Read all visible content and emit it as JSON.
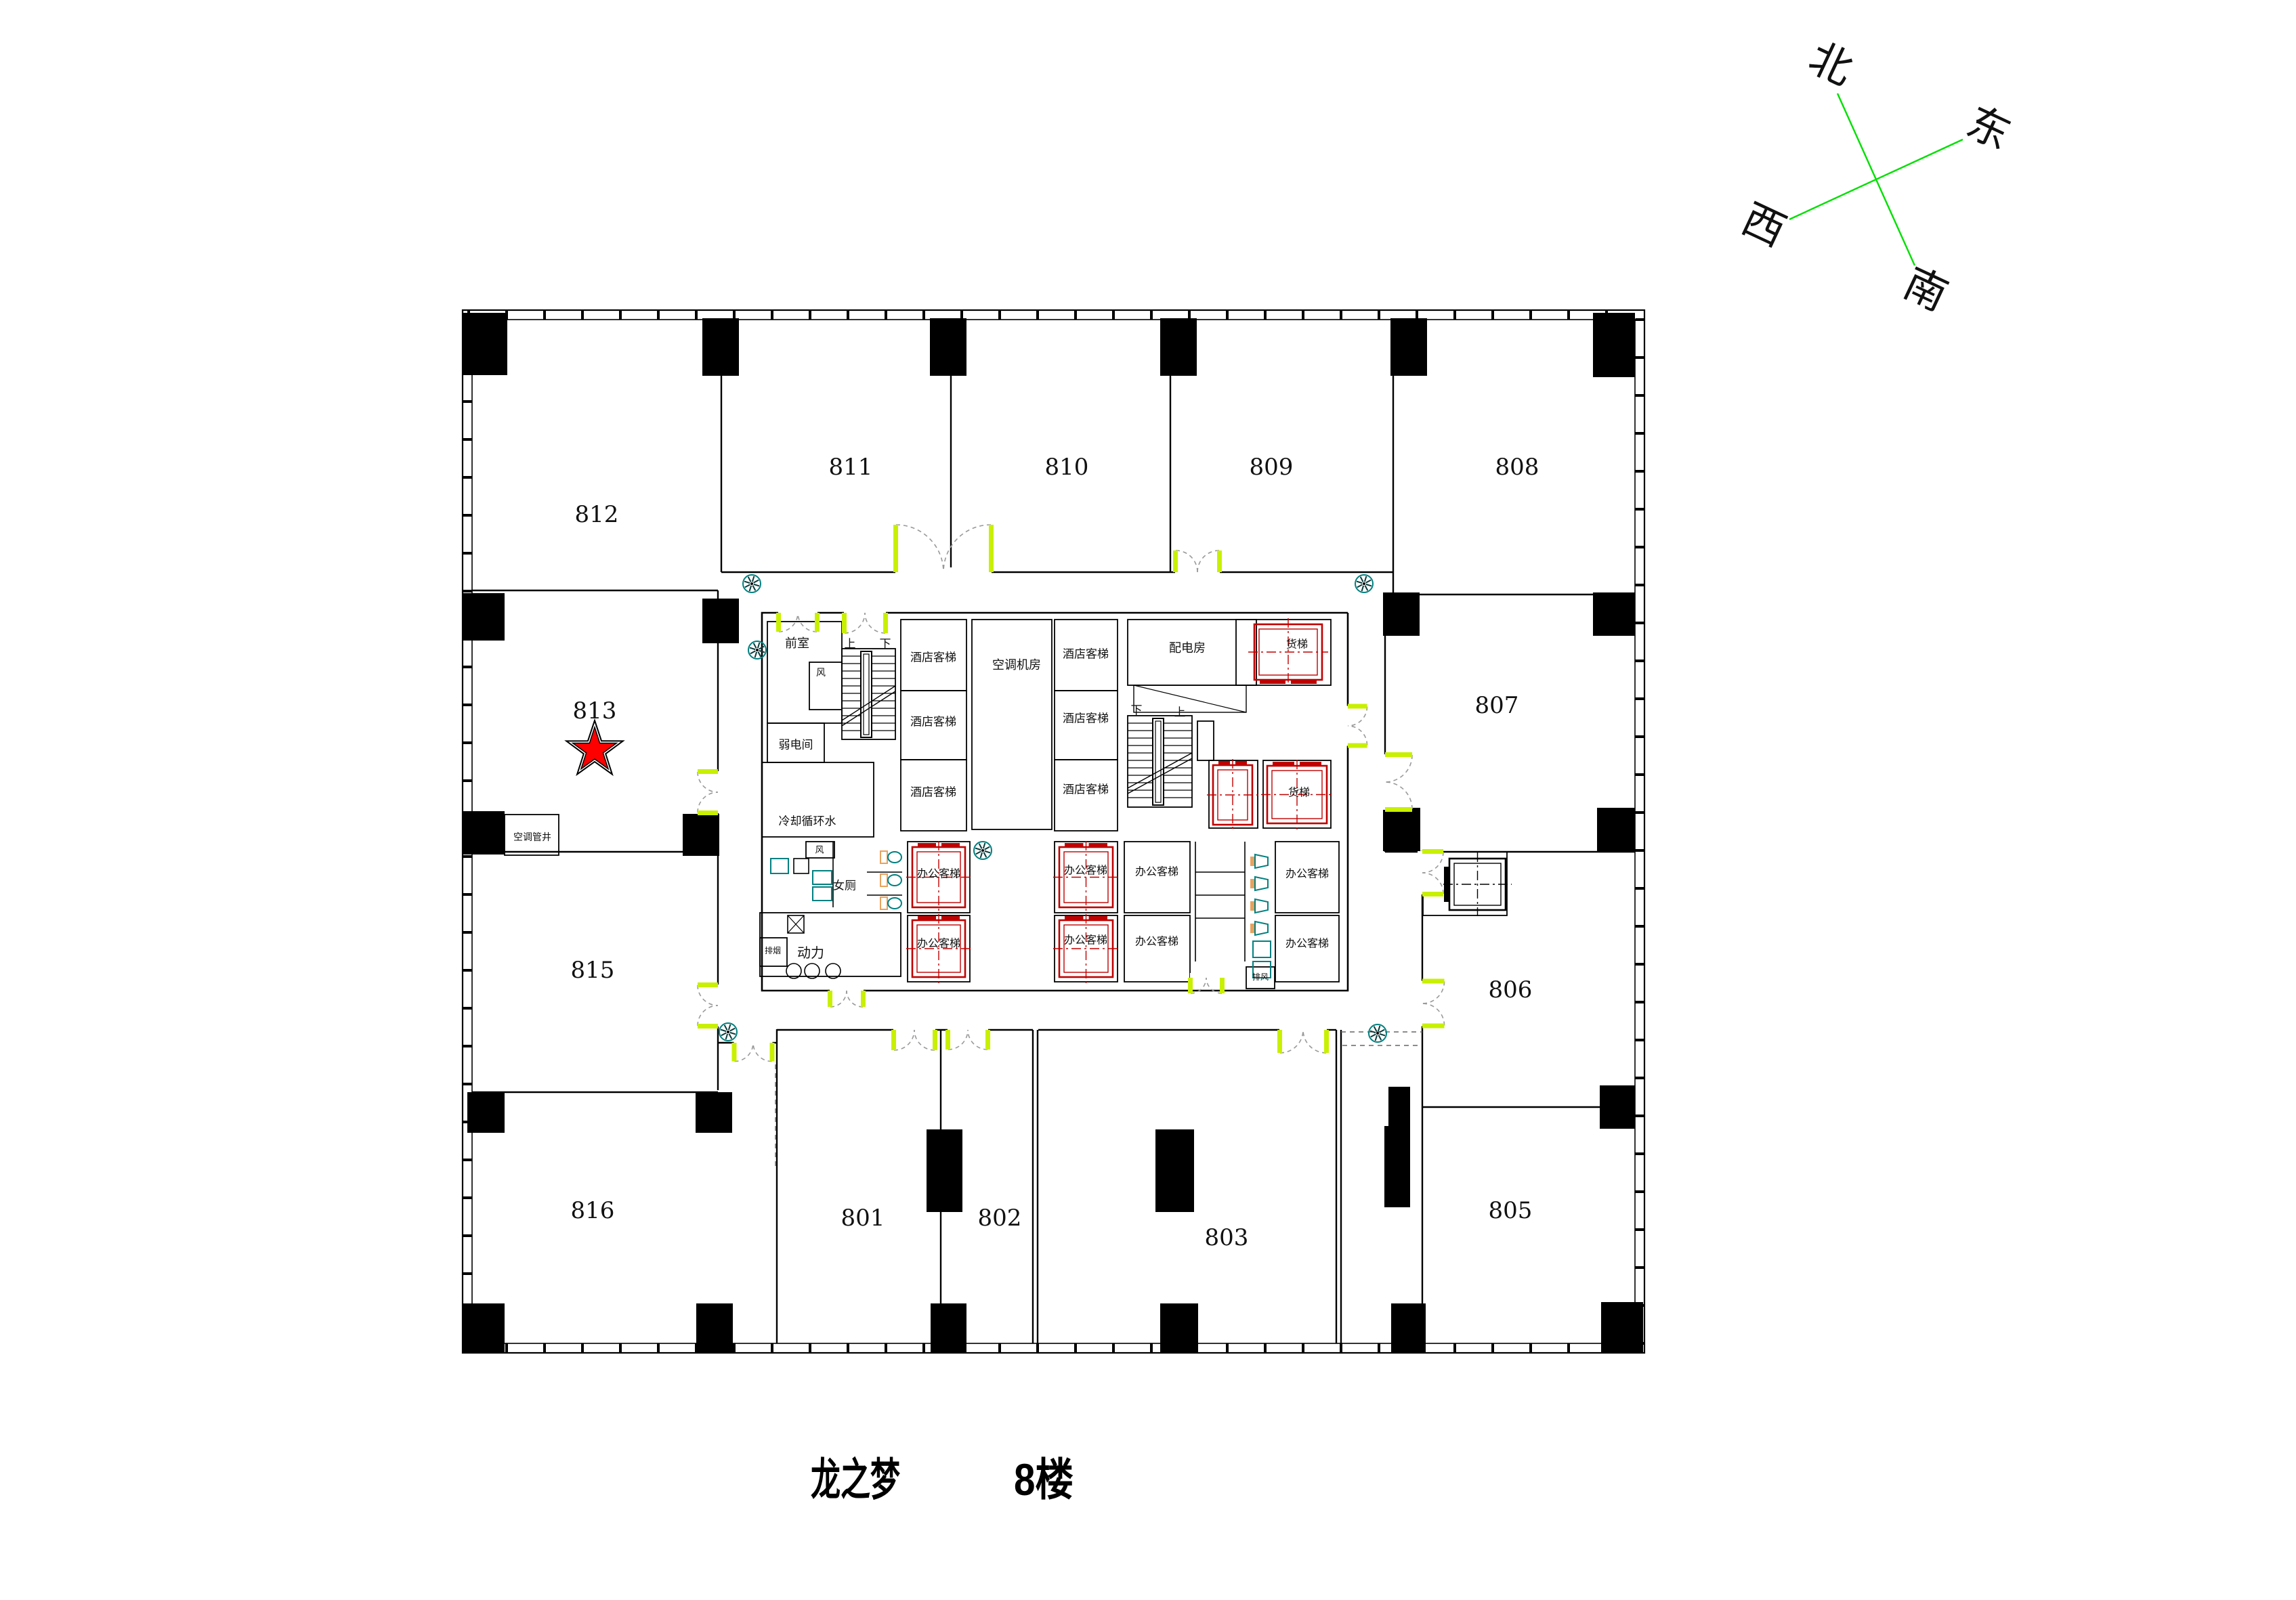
{
  "title": {
    "project": "龙之梦",
    "floor": "8楼"
  },
  "compass": {
    "north": "北",
    "east": "东",
    "west": "西",
    "south": "南"
  },
  "floor_plan": {
    "rooms": [
      {
        "id": "812"
      },
      {
        "id": "811"
      },
      {
        "id": "810"
      },
      {
        "id": "809"
      },
      {
        "id": "808"
      },
      {
        "id": "813",
        "marked": true
      },
      {
        "id": "807"
      },
      {
        "id": "815"
      },
      {
        "id": "806"
      },
      {
        "id": "816"
      },
      {
        "id": "805"
      },
      {
        "id": "801"
      },
      {
        "id": "802"
      },
      {
        "id": "803"
      }
    ],
    "highlight": {
      "room": "813",
      "marker": "red-star"
    },
    "core_labels": {
      "ante_room": "前室",
      "up": "上",
      "down": "下",
      "vent": "风",
      "weak_current_room": "弱电间",
      "cooling_water": "冷却循环水",
      "hotel_elevator": "酒店客梯",
      "ac_machine_room": "空调机房",
      "power_distribution_room": "配电房",
      "freight_elevator": "货梯",
      "womens_toilet": "女厕",
      "smoke_exhaust": "排烟",
      "power_room": "动力",
      "office_elevator": "办公客梯",
      "exhaust_air": "排风",
      "ac_pipe_shaft": "空调管井"
    },
    "colors": {
      "wall": "#000000",
      "elevator_red": "#c00000",
      "star_red": "#ff0000",
      "door_green": "#c8f000",
      "compass_green": "#00e000",
      "fixture_teal": "#008080",
      "fixture_orange": "#e8a25e",
      "swing_gray": "#999999"
    }
  }
}
